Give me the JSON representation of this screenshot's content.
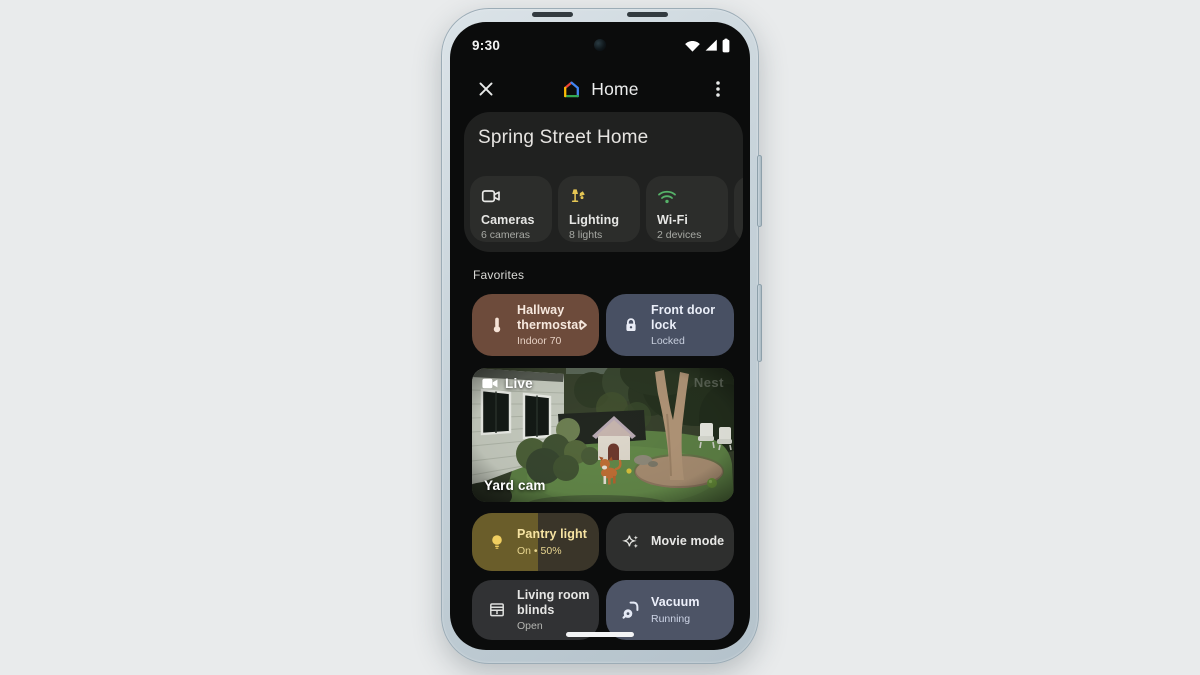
{
  "status_bar": {
    "time": "9:30"
  },
  "header": {
    "app_name": "Home"
  },
  "home_card": {
    "title": "Spring Street Home",
    "chips": [
      {
        "label": "Cameras",
        "sublabel": "6 cameras"
      },
      {
        "label": "Lighting",
        "sublabel": "8 lights"
      },
      {
        "label": "Wi-Fi",
        "sublabel": "2 devices"
      }
    ]
  },
  "favorites": {
    "heading": "Favorites",
    "thermostat": {
      "title": "Hallway thermostat",
      "status": "Indoor 70"
    },
    "lock": {
      "title": "Front door lock",
      "status": "Locked"
    },
    "camera": {
      "live_badge": "Live",
      "name": "Yard cam",
      "watermark": "Nest"
    },
    "pantry": {
      "title": "Pantry light",
      "status": "On • 50%",
      "fill_percent": 50
    },
    "movie": {
      "title": "Movie mode"
    },
    "blinds": {
      "title": "Living room blinds",
      "status": "Open"
    },
    "vacuum": {
      "title": "Vacuum",
      "status": "Running"
    }
  },
  "colors": {
    "thermostat_tile": "#6d4b3b",
    "lock_tile": "#485063",
    "pantry_fill": "#6a5d2a",
    "vacuum_tile": "#4d5466",
    "lighting_icon": "#e5c654",
    "wifi_icon": "#56b269",
    "bulb_icon": "#f1cf60",
    "card_bg": "#202120",
    "chip_bg": "#2c2d2b",
    "logo_red": "#ea4335",
    "logo_yellow": "#fbbc04",
    "logo_green": "#34a853",
    "logo_blue": "#4285f4"
  }
}
